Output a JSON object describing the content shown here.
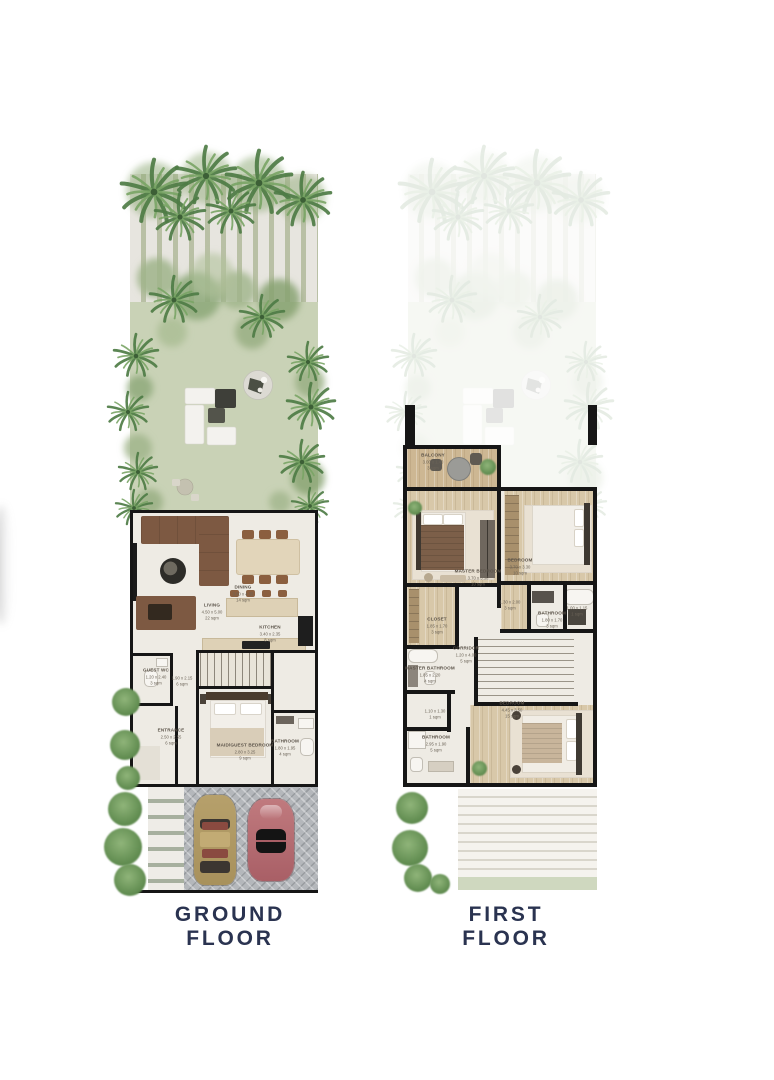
{
  "sheet": {
    "background": "#ffffff"
  },
  "colors": {
    "caption_text": "#2a3350",
    "walls": "#161616",
    "lawn": "#c9d2b6",
    "palm_green": "#4e7c45",
    "floor_cream": "#eeebe4",
    "floor_wood": "#d8c8a9",
    "car_tan": "#b19b66",
    "car_red": "#b56a6e",
    "garage_paving": "#b4b7bb"
  },
  "ground_floor": {
    "caption": "GROUND FLOOR",
    "rooms": [
      {
        "name": "LIVING",
        "dims": "4.50 x 5.00",
        "area": "22 sqm"
      },
      {
        "name": "DINING",
        "dims": "3.60 x 4.35",
        "area": "14 sqm"
      },
      {
        "name": "KITCHEN",
        "dims": "3.40 x 2.35",
        "area": "8 sqm"
      },
      {
        "name": "GUEST WC",
        "dims": "1.20 x 2.40",
        "area": "3 sqm"
      },
      {
        "name": "",
        "dims": "1.90 x 2.15",
        "area": "6 sqm"
      },
      {
        "name": "ENTRANCE",
        "dims": "2.50 x 2.55",
        "area": "6 sqm"
      },
      {
        "name": "MAID/GUEST BEDROOM",
        "dims": "2.80 x 3.25",
        "area": "9 sqm"
      },
      {
        "name": "BATHROOM",
        "dims": "1.80 x 1.95",
        "area": "4 sqm"
      }
    ]
  },
  "first_floor": {
    "caption": "FIRST FLOOR",
    "rooms": [
      {
        "name": "BALCONY",
        "dims": "3.00 x 1.40",
        "area": "3 sqm"
      },
      {
        "name": "MASTER BEDROOM",
        "dims": "3.70 x 3.30",
        "area": "10 sqm"
      },
      {
        "name": "BEDROOM",
        "dims": "3.70 x 3.30",
        "area": "10 sqm"
      },
      {
        "name": "CLOSET",
        "dims": "1.85 x 1.70",
        "area": "3 sqm"
      },
      {
        "name": "",
        "dims": "1.30 x 2.00",
        "area": "3 sqm"
      },
      {
        "name": "BATHROOM",
        "dims": "1.80 x 1.70",
        "area": "3 sqm"
      },
      {
        "name": "",
        "dims": "1.00 x 1.15",
        "area": "1 sqm"
      },
      {
        "name": "CORRIDOR",
        "dims": "1.20 x 4.00",
        "area": "5 sqm"
      },
      {
        "name": "MASTER BATHROOM",
        "dims": "1.85 x 2.20",
        "area": "4 sqm"
      },
      {
        "name": "",
        "dims": "1.10 x 1.30",
        "area": "1 sqm"
      },
      {
        "name": "BATHROOM",
        "dims": "2.95 x 1.90",
        "area": "5 sqm"
      },
      {
        "name": "BEDROOM",
        "dims": "4.45 x 3.50",
        "area": "15 sqm"
      }
    ]
  }
}
